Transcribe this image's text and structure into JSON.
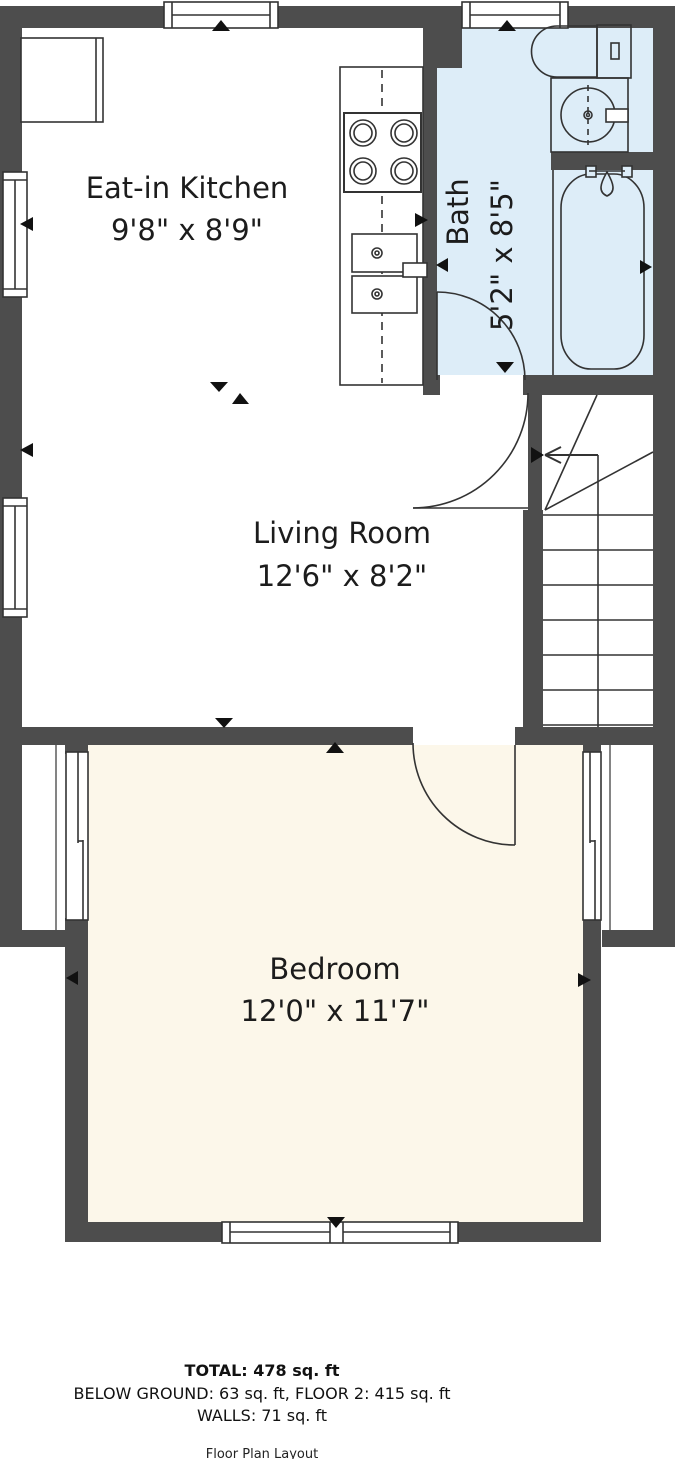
{
  "title": "Floor Plan Layout",
  "colors": {
    "wall": "#4d4d4d",
    "bath_fill": "#ddedf8",
    "bedroom_fill": "#fcf7ea",
    "line": "#333333",
    "marker": "#111111",
    "floor_fill": "#ffffff"
  },
  "rooms": [
    {
      "id": "kitchen",
      "name": "Eat-in Kitchen",
      "dims": "9'8\" x 8'9\""
    },
    {
      "id": "bath",
      "name": "Bath",
      "dims": "5'2\" x 8'5\""
    },
    {
      "id": "living",
      "name": "Living Room",
      "dims": "12'6\" x 8'2\""
    },
    {
      "id": "bedroom",
      "name": "Bedroom",
      "dims": "12'0\" x 11'7\""
    }
  ],
  "fixtures": [
    "refrigerator",
    "stove",
    "kitchen-sink",
    "toilet",
    "vanity-sink",
    "bathtub",
    "stairs",
    "doors",
    "windows"
  ],
  "footer": {
    "total": "TOTAL: 478 sq. ft",
    "breakdown": "BELOW GROUND: 63 sq. ft, FLOOR 2: 415 sq. ft",
    "walls": "WALLS: 71 sq. ft",
    "caption": "Floor Plan Layout"
  }
}
